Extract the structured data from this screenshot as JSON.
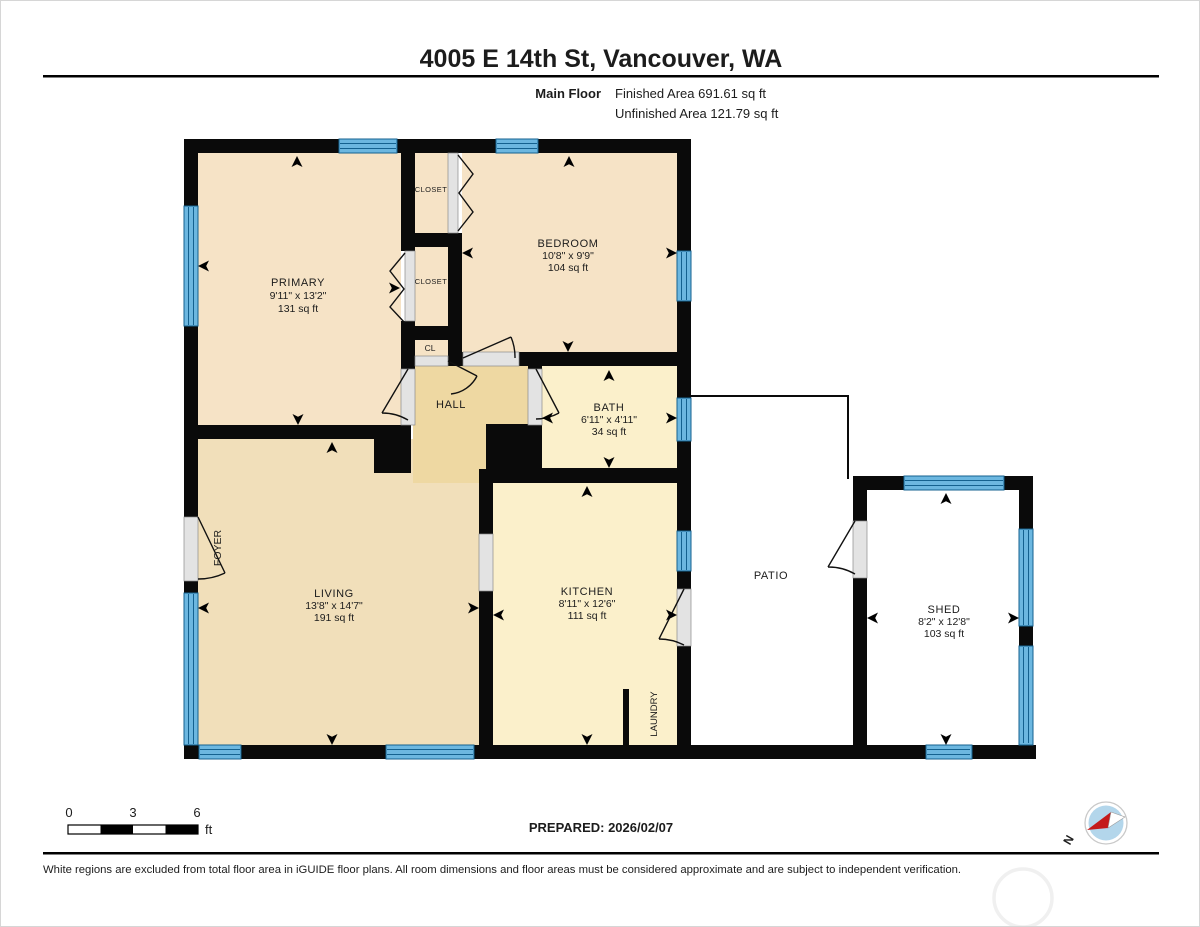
{
  "header": {
    "title": "4005 E 14th St, Vancouver, WA",
    "floor_label": "Main Floor",
    "finished_area": "Finished Area 691.61 sq ft",
    "unfinished_area": "Unfinished Area 121.79 sq ft"
  },
  "rooms": {
    "primary": {
      "name": "PRIMARY",
      "dims": "9'11\" x 13'2\"",
      "area": "131 sq ft"
    },
    "bedroom": {
      "name": "BEDROOM",
      "dims": "10'8\" x 9'9\"",
      "area": "104 sq ft"
    },
    "bath": {
      "name": "BATH",
      "dims": "6'11\" x 4'11\"",
      "area": "34 sq ft"
    },
    "living": {
      "name": "LIVING",
      "dims": "13'8\" x 14'7\"",
      "area": "191 sq ft"
    },
    "kitchen": {
      "name": "KITCHEN",
      "dims": "8'11\" x 12'6\"",
      "area": "111 sq ft"
    },
    "shed": {
      "name": "SHED",
      "dims": "8'2\" x 12'8\"",
      "area": "103 sq ft"
    },
    "hall": {
      "name": "HALL"
    },
    "closet_top": {
      "name": "CLOSET"
    },
    "closet_mid": {
      "name": "CLOSET"
    },
    "closet_small": {
      "name": "CL"
    },
    "foyer": {
      "name": "FOYER"
    },
    "laundry": {
      "name": "LAUNDRY"
    },
    "patio": {
      "name": "PATIO"
    }
  },
  "footer": {
    "scale": {
      "tick0": "0",
      "tick3": "3",
      "tick6": "6",
      "unit": "ft"
    },
    "prepared": "PREPARED: 2026/02/07",
    "disclaimer": "White regions are excluded from total floor area in iGUIDE floor plans. All room dimensions and floor areas must be considered approximate and are subject to independent verification.",
    "compass_north": "N"
  },
  "colors": {
    "wall": "#0a0a0a",
    "room_tan": "#f6e3c6",
    "room_living": "#f1dfba",
    "room_hall": "#eed8a2",
    "room_cream": "#fbf0cb",
    "window_blue": "#6cb7e0",
    "window_line": "#14618f",
    "door_gray": "#e3e3e3",
    "compass_fill": "#b3d6eb",
    "compass_red": "#c41a1a"
  }
}
